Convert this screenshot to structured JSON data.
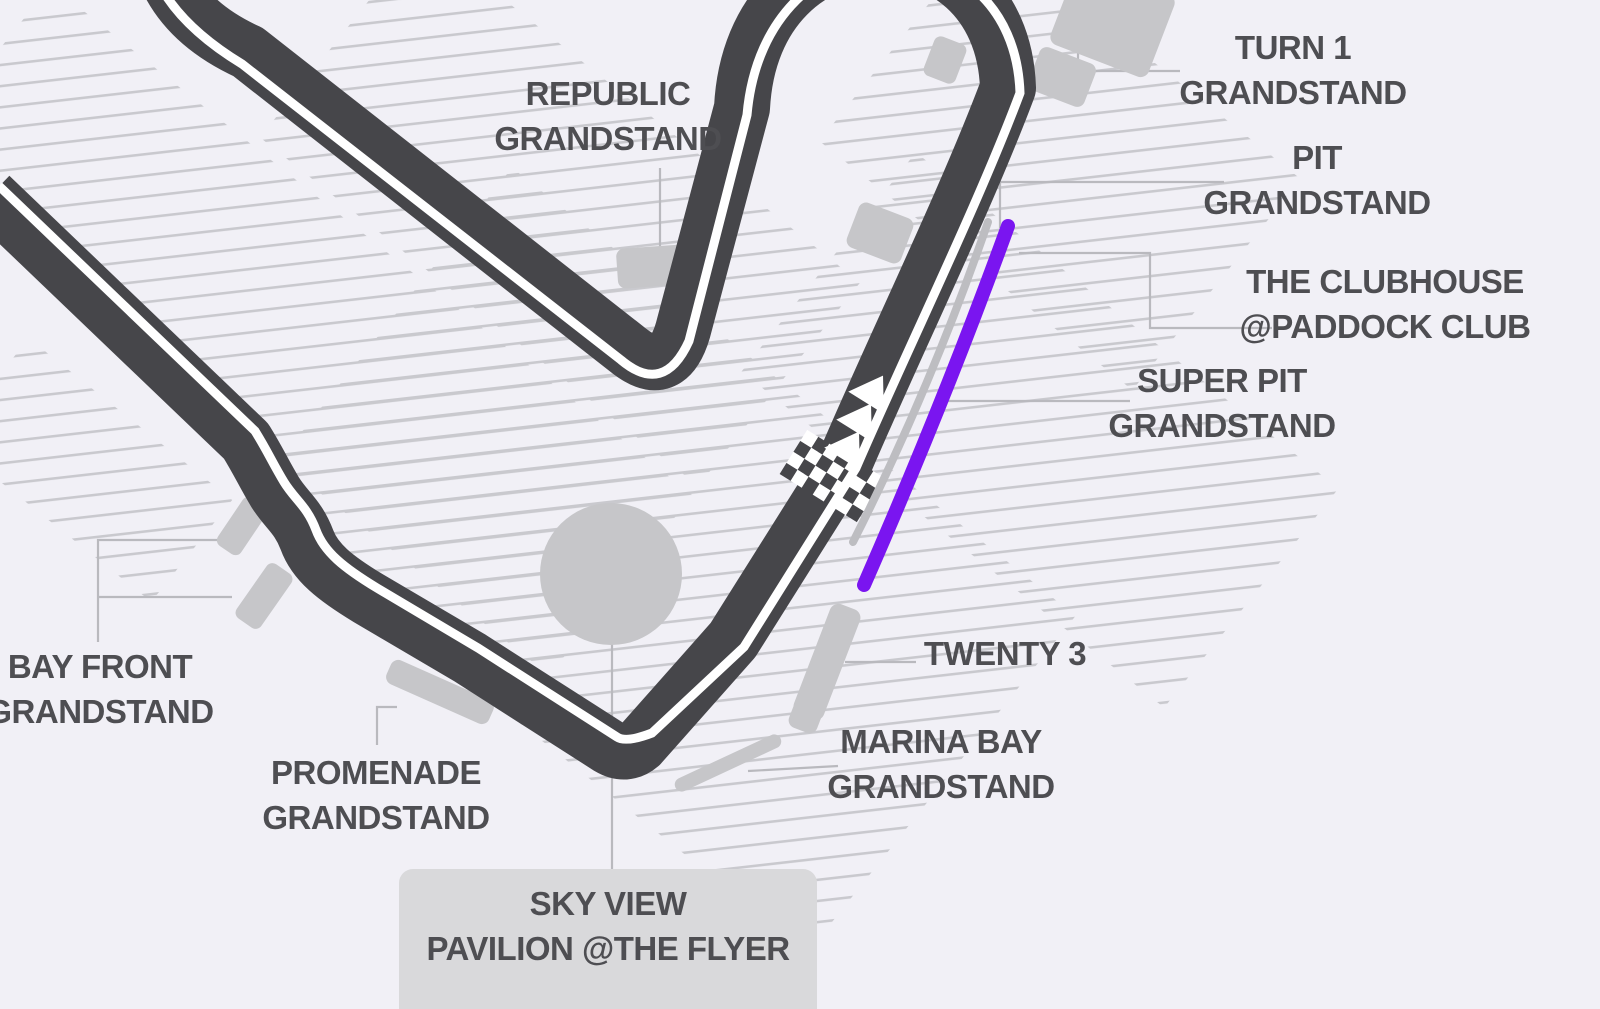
{
  "map": {
    "type": "street-circuit-seating-map",
    "highlighted_section_color_meaning": "purple line marks pit straight grandstand frontage",
    "start_finish_marker": "checkered-flag-band",
    "direction_marker": "three-white-arrows"
  },
  "colors": {
    "bg": "#F1F0F6",
    "track": "#46464A",
    "trackline": "#FFFFFF",
    "hatch": "#C9C9CE",
    "block": "#C6C6C9",
    "box": "#D9D9DB",
    "leader": "#B9B9BE",
    "text": "#4E4E52",
    "purple": "#7A15F0",
    "pitwall": "#BDBDC1"
  },
  "labels": {
    "republic": {
      "line1": "REPUBLIC",
      "line2": "GRANDSTAND"
    },
    "turn1": {
      "line1": "TURN 1",
      "line2": "GRANDSTAND"
    },
    "pit": {
      "line1": "PIT",
      "line2": "GRANDSTAND"
    },
    "clubhouse": {
      "line1": "THE CLUBHOUSE",
      "line2": "@PADDOCK CLUB"
    },
    "super_pit": {
      "line1": "SUPER PIT",
      "line2": "GRANDSTAND"
    },
    "twenty3": {
      "line1": "TWENTY 3"
    },
    "marina_bay": {
      "line1": "MARINA BAY",
      "line2": "GRANDSTAND"
    },
    "bay_front": {
      "line1": "BAY FRONT",
      "line2": "GRANDSTAND"
    },
    "promenade": {
      "line1": "PROMENADE",
      "line2": "GRANDSTAND"
    },
    "sky_view": {
      "line1": "SKY VIEW",
      "line2": "PAVILION @THE FLYER"
    }
  }
}
